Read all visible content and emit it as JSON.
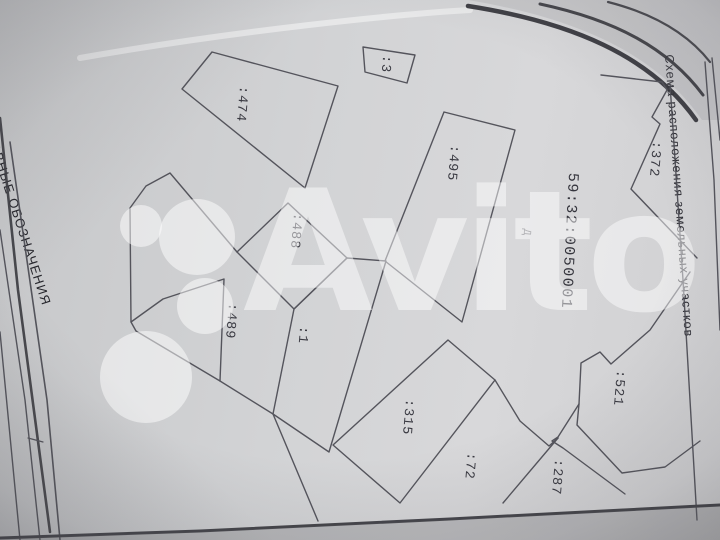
{
  "watermark": {
    "brand": "Avito"
  },
  "page": {
    "right_title": "Схема расположения земельных участков",
    "left_legend_title": "УСЛОВНЫЕ ОБОЗНАЧЕНИЯ"
  },
  "map": {
    "cadastral_quarter_number": "59:32:0050001",
    "building_letter": "Д",
    "parcels": [
      {
        "label": ":3"
      },
      {
        "label": ":474"
      },
      {
        "label": ":495"
      },
      {
        "label": ":488"
      },
      {
        "label": ":489"
      },
      {
        "label": ":1"
      },
      {
        "label": ":315"
      },
      {
        "label": ":72"
      },
      {
        "label": ":287"
      },
      {
        "label": ":521"
      },
      {
        "label": ":372"
      }
    ]
  },
  "colors": {
    "page": "#d2d3d5",
    "ink_lines": "#4a4a52",
    "ink_text": "#3a3a42",
    "watermark_white": "rgba(255,255,255,0.48)"
  }
}
